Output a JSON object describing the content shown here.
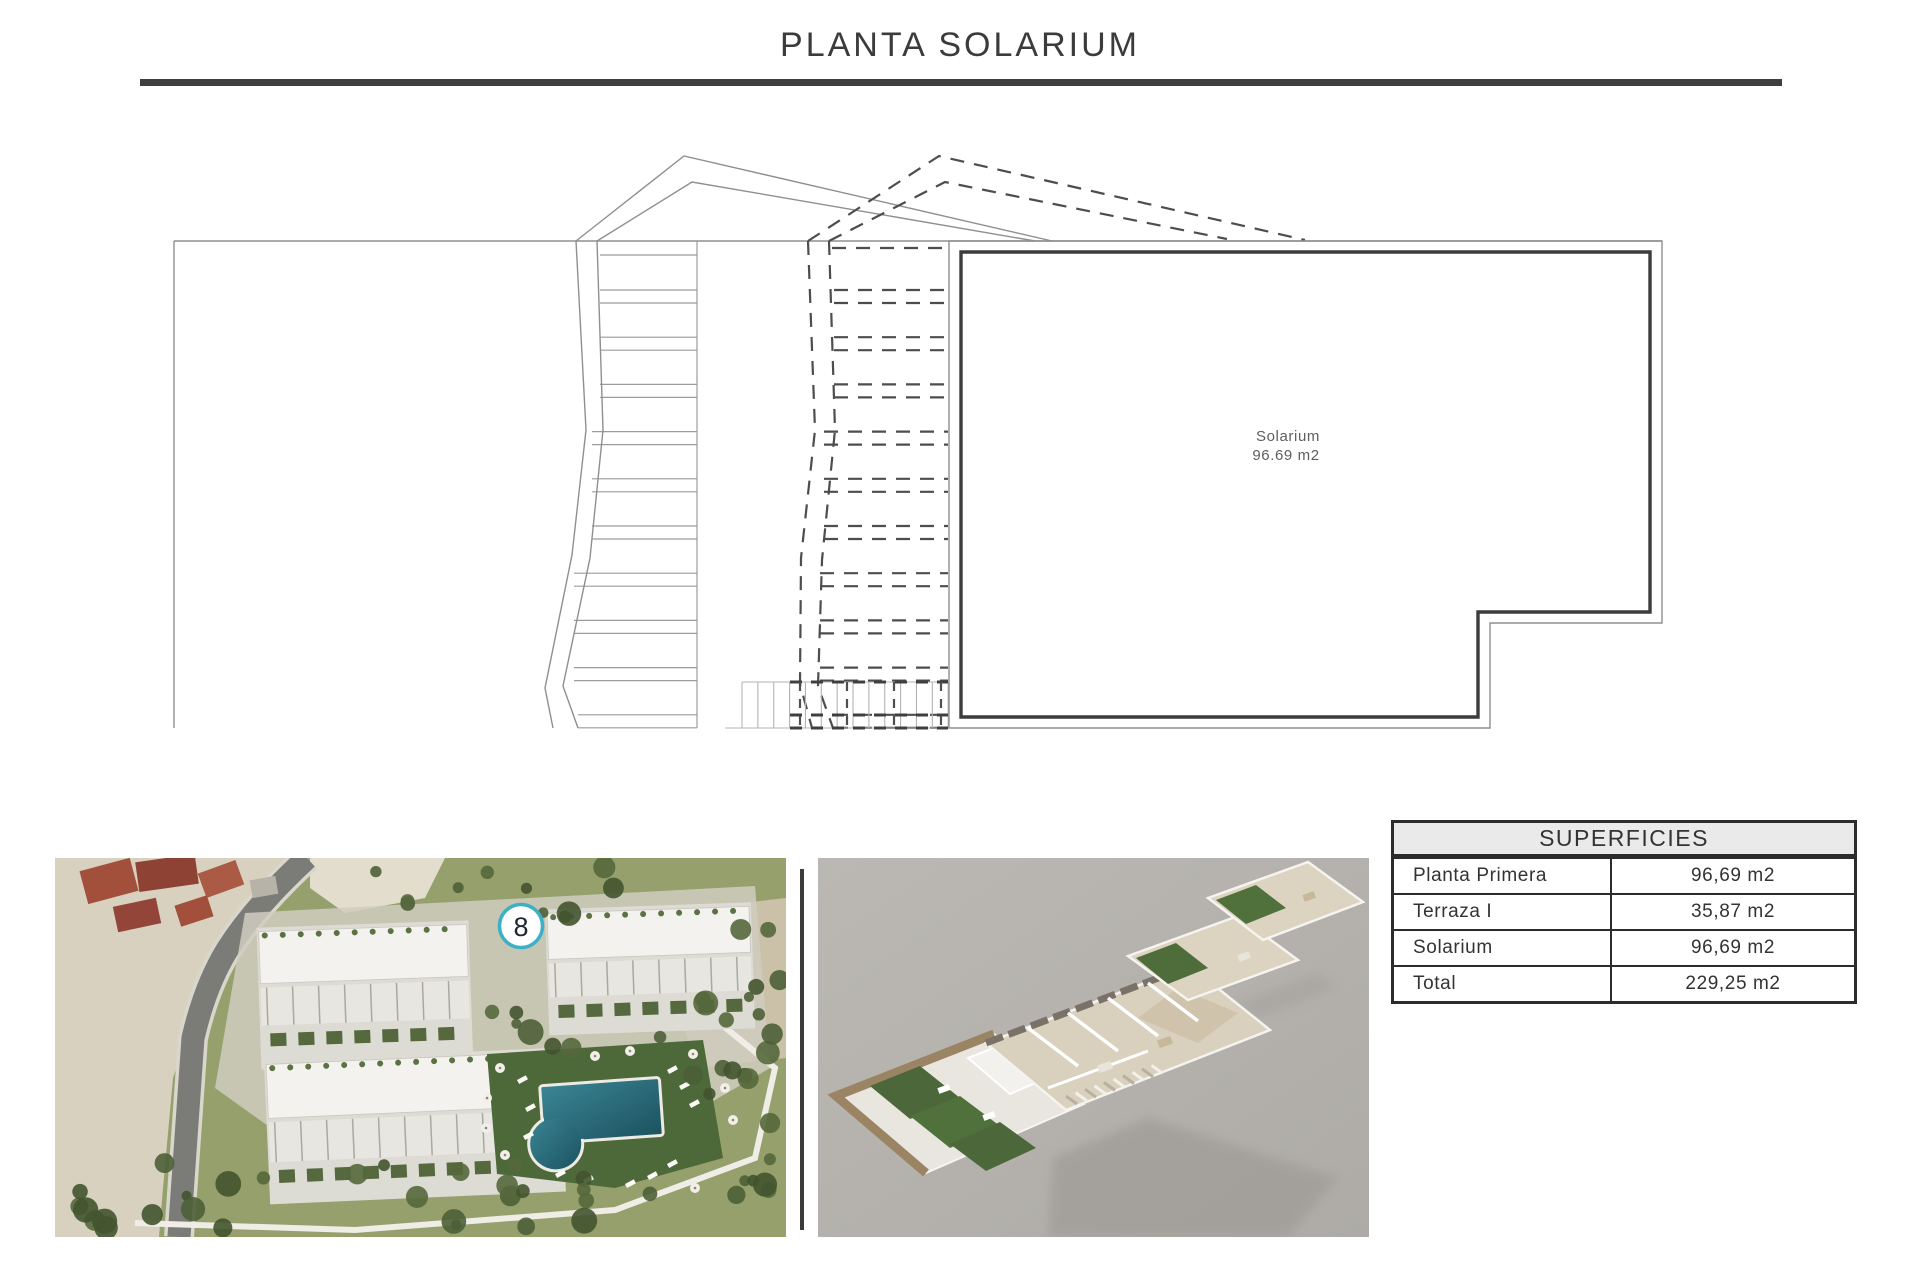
{
  "title": "PLANTA SOLARIUM",
  "plan": {
    "room_name": "Solarium",
    "room_area": "96.69 m2"
  },
  "aerial": {
    "badge_number": "8"
  },
  "table": {
    "header": "SUPERFICIES",
    "rows": [
      {
        "label": "Planta Primera",
        "value": "96,69 m2"
      },
      {
        "label": "Terraza I",
        "value": "35,87 m2"
      },
      {
        "label": "Solarium",
        "value": "96,69 m2"
      },
      {
        "label": "Total",
        "value": "229,25 m2"
      }
    ]
  },
  "colors": {
    "accent_teal": "#3eb0c6",
    "pool": "#2f6f7d",
    "table_header_bg": "#eaeaea",
    "line_dark": "#3c3c3c"
  }
}
